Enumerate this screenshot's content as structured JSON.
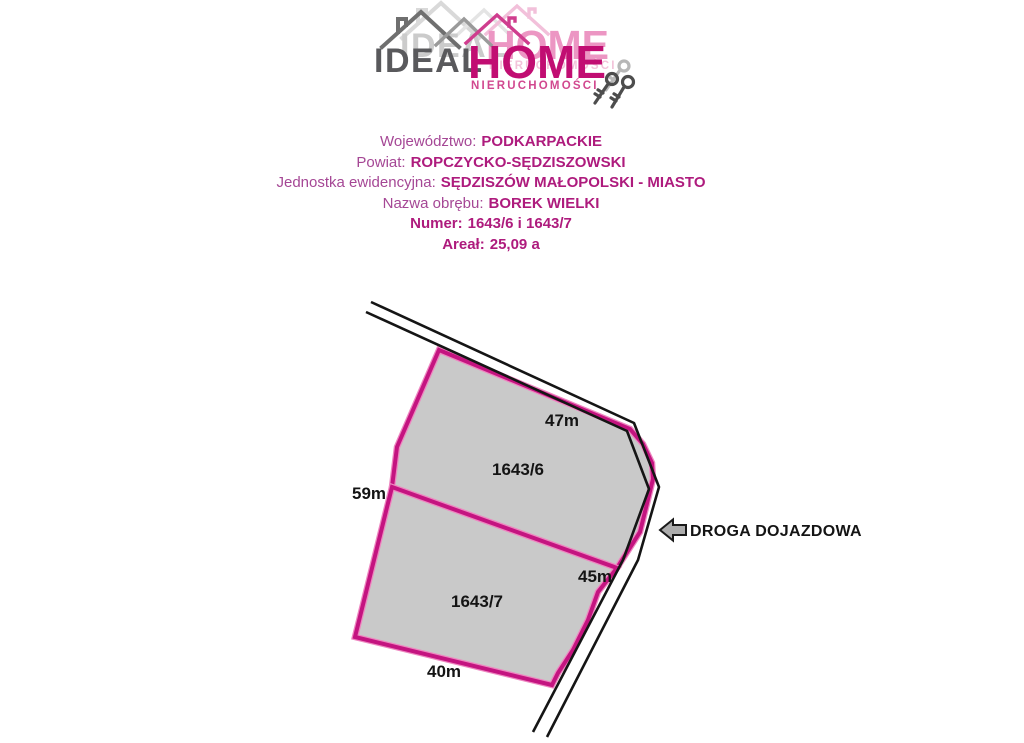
{
  "logo": {
    "ideal": "IDEAL",
    "home": "HOME",
    "subtitle": "NIERUCHOMOŚCI",
    "colors": {
      "ideal": "#59595c",
      "home": "#c10d72",
      "subtitle": "#d1488f"
    }
  },
  "property_info": {
    "lines": [
      {
        "label": "Województwo:",
        "value": "PODKARPACKIE"
      },
      {
        "label": "Powiat:",
        "value": "ROPCZYCKO-SĘDZISZOWSKI"
      },
      {
        "label": "Jednostka ewidencyjna:",
        "value": "SĘDZISZÓW MAŁOPOLSKI - MIASTO"
      },
      {
        "label": "Nazwa obrębu:",
        "value": "BOREK WIELKI"
      },
      {
        "label": "Numer:",
        "value": "1643/6 i 1643/7"
      },
      {
        "label": "Areał:",
        "value": "25,09 a"
      }
    ],
    "label_color": "#a54795",
    "value_color": "#ae1b7d"
  },
  "map": {
    "parcels": [
      {
        "id": "1643/6",
        "top_length": "47m",
        "left_length": "59m"
      },
      {
        "id": "1643/7",
        "right_length": "45m",
        "bottom_length": "40m"
      }
    ],
    "road_label": "DROGA DOJAZDOWA",
    "colors": {
      "parcel_fill": "#c9c9c9",
      "parcel_stroke": "#c41480",
      "road_line": "#151515",
      "label": "#141414"
    }
  }
}
